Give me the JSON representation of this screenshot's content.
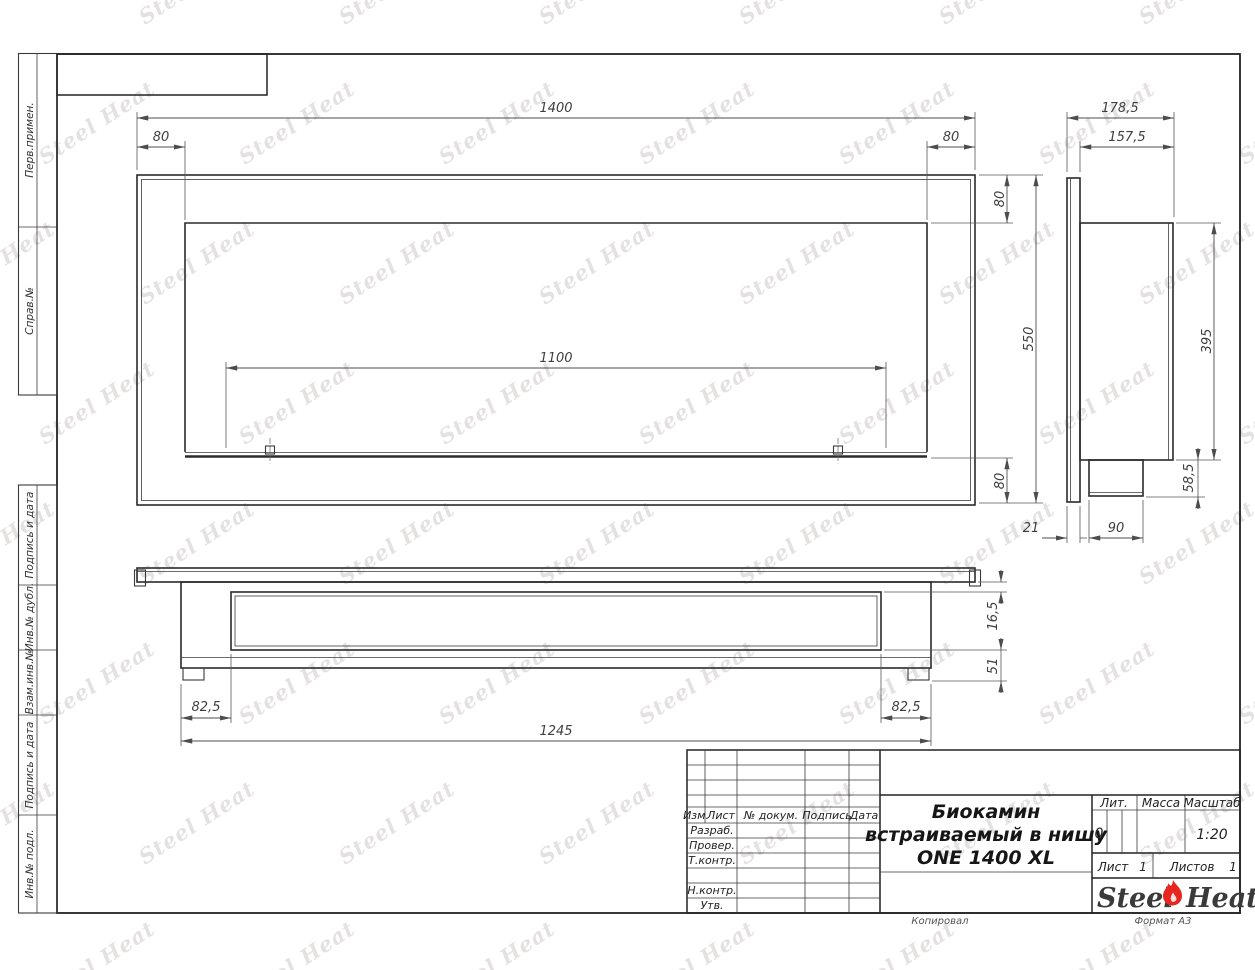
{
  "watermark": {
    "text": "Steel Heat"
  },
  "margin_labels": [
    "Перв.примен.",
    "Справ.№",
    "Подпись и дата",
    "Инв.№ дубл.",
    "Взам.инв.№",
    "Подпись и дата",
    "Инв.№ подл."
  ],
  "dims": {
    "front": {
      "total_width": "1400",
      "left_offset": "80",
      "right_offset": "80",
      "top_offset": "80",
      "total_height": "550",
      "bottom_offset": "80",
      "burner_length": "1100"
    },
    "side": {
      "total_depth": "178,5",
      "body_depth": "157,5",
      "body_height": "395",
      "bottom_box_height": "58,5",
      "flange_thickness": "21",
      "bottom_box_width": "90"
    },
    "plan": {
      "left_inset": "82,5",
      "right_inset": "82,5",
      "body_width": "1245",
      "flange_to_slot": "16,5",
      "slot_to_back": "51"
    }
  },
  "title_block": {
    "col_izm": "Изм.",
    "col_list": "Лист",
    "col_doc": "№ докум.",
    "col_sign": "Подпись",
    "col_date": "Дата",
    "row_razrab": "Разраб.",
    "row_prover": "Провер.",
    "row_tkontr": "Т.контр.",
    "row_nkontr": "Н.контр.",
    "row_utv": "Утв.",
    "title_line1": "Биокамин",
    "title_line2": "встраиваемый в нишу",
    "title_line3": "ONE 1400 XL",
    "lit_label": "Лит.",
    "lit_value": "0",
    "mass_label": "Масса",
    "scale_label": "Масштаб",
    "scale_value": "1:20",
    "sheet_label": "Лист",
    "sheet_value": "1",
    "sheets_label": "Листов",
    "sheets_value": "1",
    "brand_left": "Steel",
    "brand_right": "Heat"
  },
  "footer": {
    "copied": "Копировал",
    "format": "Формат А3"
  },
  "accent_colors": {
    "flame_red": "#e6261f",
    "line_dark": "#2b2b2b",
    "dim_gray": "#4d4d4d"
  }
}
